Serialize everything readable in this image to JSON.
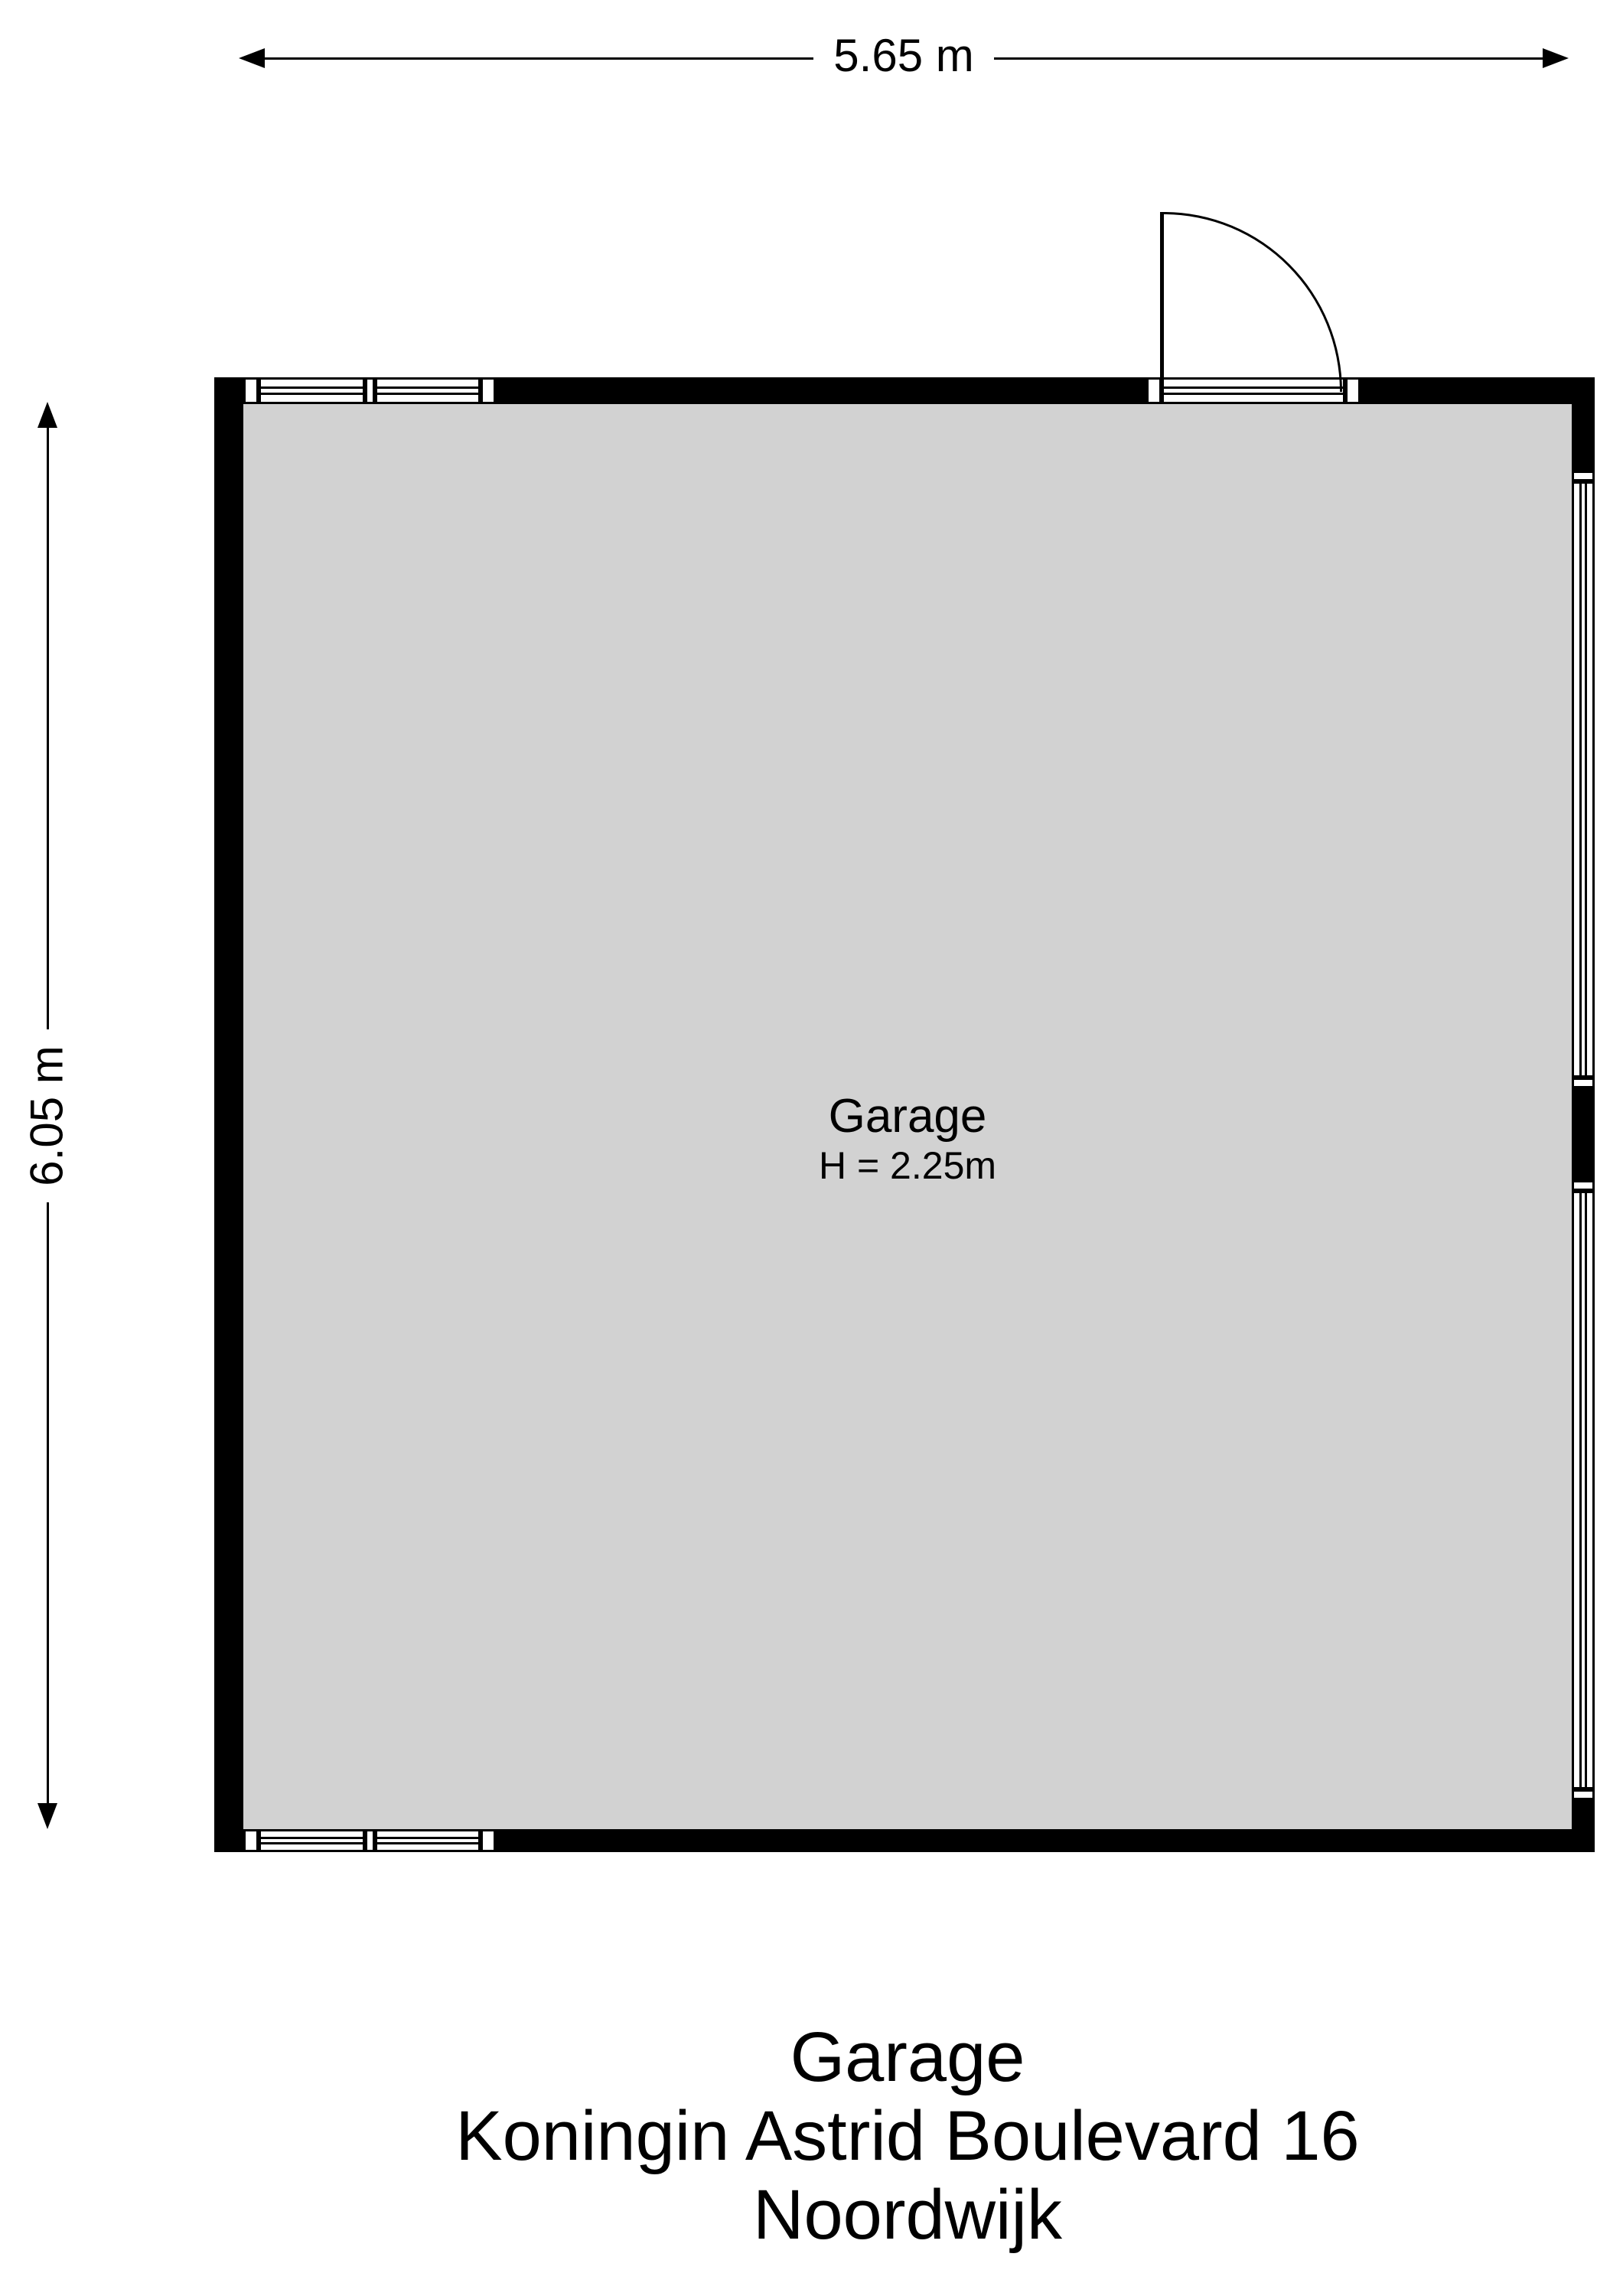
{
  "colors": {
    "floor": "#d2d2d2",
    "wall": "#000000",
    "line": "#000000",
    "background": "#ffffff"
  },
  "dimension_labels": {
    "width": "5.65 m",
    "height": "6.05 m"
  },
  "room_label": {
    "name": "Garage",
    "ceiling_height": "H = 2.25m"
  },
  "footer": {
    "title": "Garage",
    "address": "Koningin Astrid Boulevard 16",
    "city": "Noordwijk"
  }
}
